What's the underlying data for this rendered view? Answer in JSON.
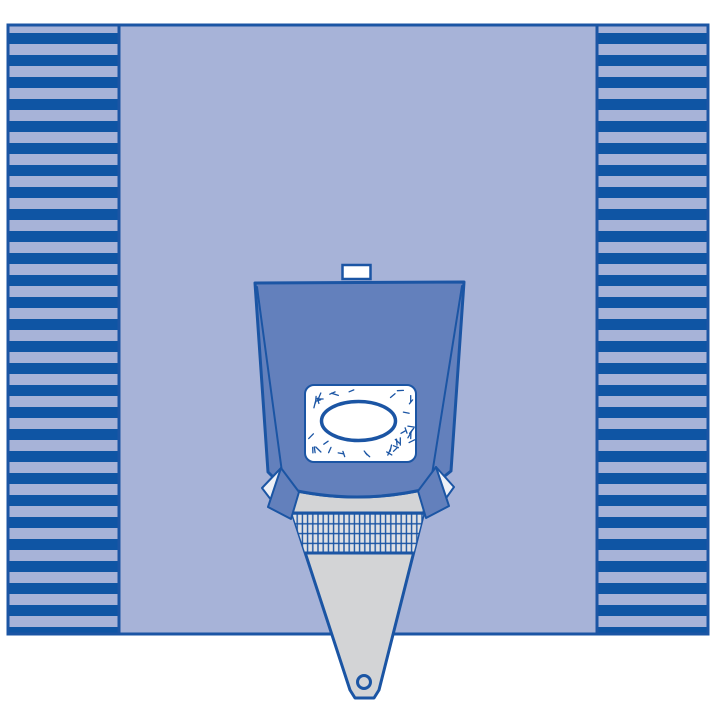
{
  "figure": {
    "description": "Line-art product illustration of a disposable surgical drape: a large square drape with pleated fold strips on the left and right edges, and a centered under-buttocks style pouch with a speckled adhesive incise window, oval fenestration, mesh filter screen and a tapered fluid-collection funnel ending in a drain port below the drape edge.",
    "alt": "Surgical drape with fluid collection pouch illustration"
  },
  "colors": {
    "background": "#ffffff",
    "field": "#a7b3d8",
    "stripe": "#0f55a4",
    "outline": "#1b55a4",
    "pouch": "#6380bc",
    "funnel_gray": "#d3d4d6",
    "mesh_cell": "#dee0e4",
    "white": "#ffffff",
    "wing_underside": "#eef0f6"
  },
  "speckles": {
    "count": 95,
    "seed": 17
  }
}
